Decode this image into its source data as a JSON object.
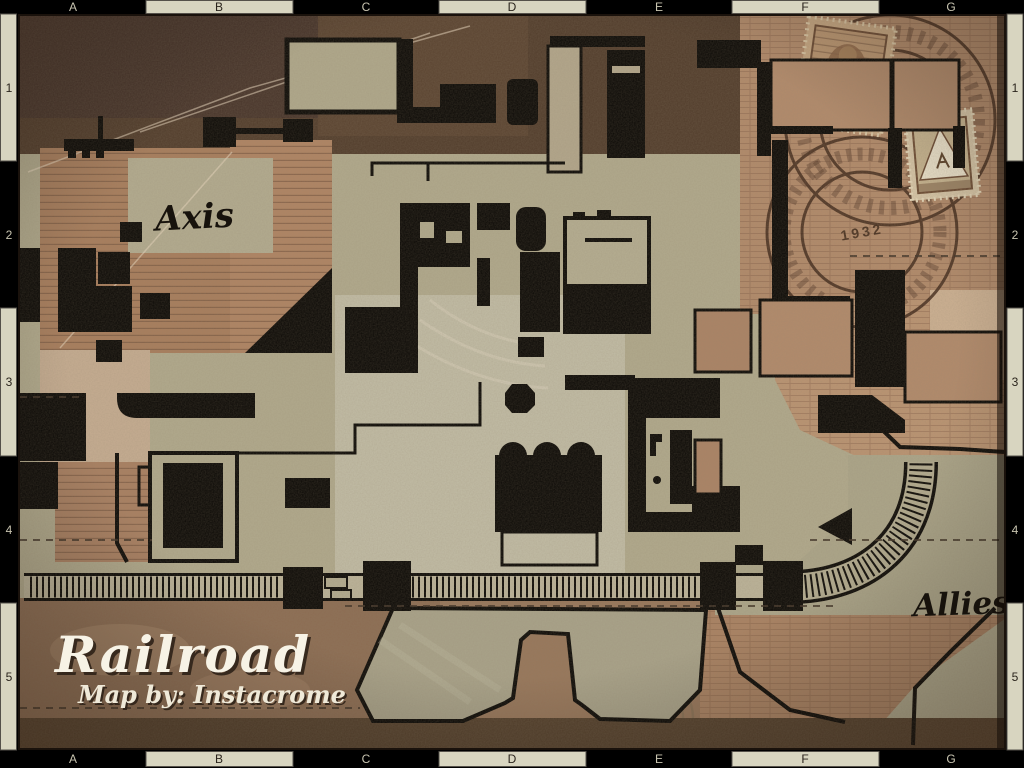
{
  "map": {
    "title": "Railroad",
    "credit": "Map by: Instacrome",
    "labels": {
      "axis": "Axis",
      "allies": "Allies"
    }
  },
  "grid": {
    "columns": [
      "A",
      "B",
      "C",
      "D",
      "E",
      "F",
      "G"
    ],
    "rows": [
      "1",
      "2",
      "3",
      "4",
      "5"
    ]
  },
  "stamps": {
    "postmark_year": "1932"
  },
  "colors": {
    "wall_black": "#0a0805",
    "paper_dark_brown": "#54402c",
    "paper_tan": "#b28a6a",
    "playfield_khaki": "#b1aa8d",
    "ruler_tab": "#d8d5c0",
    "ruler_black": "#000000",
    "title_white": "#f7f3e6"
  }
}
